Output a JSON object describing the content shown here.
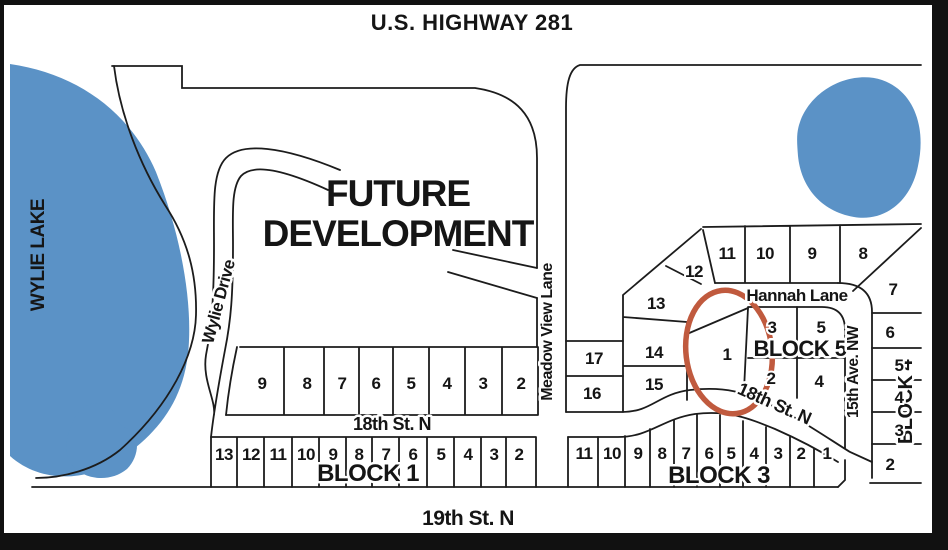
{
  "title": "U.S. HIGHWAY 281",
  "labels": {
    "lake": "WYLIE LAKE",
    "future_line1": "FUTURE",
    "future_line2": "DEVELOPMENT",
    "wylie_drive": "Wylie Drive",
    "meadow_view_lane": "Meadow View Lane",
    "hannah_lane": "Hannah Lane",
    "ave_15": "15th Ave. NW",
    "st_18_west": "18th St. N",
    "st_18_east": "18th St. N",
    "st_19": "19th St. N",
    "block1": "BLOCK 1",
    "block3": "BLOCK 3",
    "block4": "BLOCK 4",
    "block5": "BLOCK 5"
  },
  "colors": {
    "water": "#5b92c6",
    "highlight_circle": "#c05a3e",
    "line": "#1c1c1c",
    "text": "#151515"
  },
  "highlight": {
    "circled_lot": "1",
    "block": "BLOCK 5"
  },
  "lots": {
    "block1_top": [
      {
        "label": "9",
        "x": 262,
        "y": 389
      },
      {
        "label": "8",
        "x": 307,
        "y": 389
      },
      {
        "label": "7",
        "x": 342,
        "y": 389
      },
      {
        "label": "6",
        "x": 376,
        "y": 389
      },
      {
        "label": "5",
        "x": 411,
        "y": 389
      },
      {
        "label": "4",
        "x": 447,
        "y": 389
      },
      {
        "label": "3",
        "x": 483,
        "y": 389
      },
      {
        "label": "2",
        "x": 521,
        "y": 389
      }
    ],
    "block1_bottom": [
      {
        "label": "13",
        "x": 224,
        "y": 460
      },
      {
        "label": "12",
        "x": 251,
        "y": 460
      },
      {
        "label": "11",
        "x": 278,
        "y": 460
      },
      {
        "label": "10",
        "x": 306,
        "y": 460
      },
      {
        "label": "9",
        "x": 333,
        "y": 460
      },
      {
        "label": "8",
        "x": 359,
        "y": 460
      },
      {
        "label": "7",
        "x": 386,
        "y": 460
      },
      {
        "label": "6",
        "x": 413,
        "y": 460
      },
      {
        "label": "5",
        "x": 441,
        "y": 460
      },
      {
        "label": "4",
        "x": 468,
        "y": 460
      },
      {
        "label": "3",
        "x": 494,
        "y": 460
      },
      {
        "label": "2",
        "x": 519,
        "y": 460
      }
    ],
    "block3": [
      {
        "label": "11",
        "x": 584,
        "y": 459
      },
      {
        "label": "10",
        "x": 612,
        "y": 459
      },
      {
        "label": "9",
        "x": 638,
        "y": 459
      },
      {
        "label": "8",
        "x": 662,
        "y": 459
      },
      {
        "label": "7",
        "x": 686,
        "y": 459
      },
      {
        "label": "6",
        "x": 709,
        "y": 459
      },
      {
        "label": "5",
        "x": 731,
        "y": 459
      },
      {
        "label": "4",
        "x": 754,
        "y": 459
      },
      {
        "label": "3",
        "x": 778,
        "y": 459
      },
      {
        "label": "2",
        "x": 801,
        "y": 459
      },
      {
        "label": "1",
        "x": 827,
        "y": 459
      }
    ],
    "north_row": [
      {
        "label": "11",
        "x": 727,
        "y": 259
      },
      {
        "label": "10",
        "x": 765,
        "y": 259
      },
      {
        "label": "9",
        "x": 812,
        "y": 259
      },
      {
        "label": "8",
        "x": 863,
        "y": 259
      }
    ],
    "west_cluster": [
      {
        "label": "12",
        "x": 694,
        "y": 277
      },
      {
        "label": "13",
        "x": 656,
        "y": 309
      },
      {
        "label": "14",
        "x": 654,
        "y": 358
      },
      {
        "label": "15",
        "x": 654,
        "y": 390
      },
      {
        "label": "17",
        "x": 594,
        "y": 364
      },
      {
        "label": "16",
        "x": 592,
        "y": 399
      }
    ],
    "block5_cluster": [
      {
        "label": "1",
        "x": 727,
        "y": 360
      },
      {
        "label": "3",
        "x": 772,
        "y": 333
      },
      {
        "label": "5",
        "x": 821,
        "y": 333
      },
      {
        "label": "2",
        "x": 771,
        "y": 384
      },
      {
        "label": "4",
        "x": 819,
        "y": 387
      }
    ],
    "east_cluster": [
      {
        "label": "7",
        "x": 893,
        "y": 295
      },
      {
        "label": "6",
        "x": 890,
        "y": 338
      },
      {
        "label": "5",
        "x": 899,
        "y": 371
      },
      {
        "label": "4",
        "x": 899,
        "y": 403
      },
      {
        "label": "3",
        "x": 899,
        "y": 436
      },
      {
        "label": "2",
        "x": 890,
        "y": 470
      }
    ]
  }
}
